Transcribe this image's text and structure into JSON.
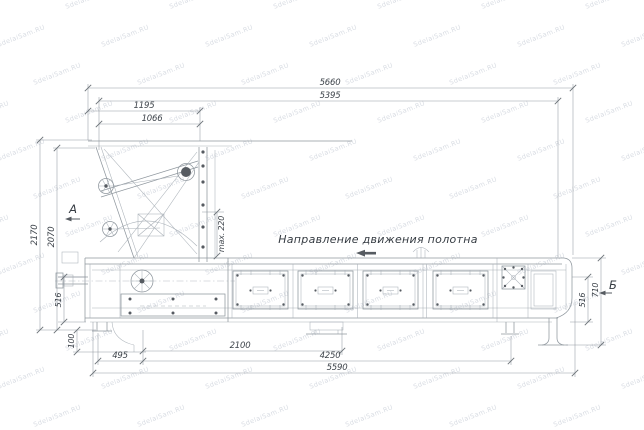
{
  "dims": {
    "d5660": "5660",
    "d5395": "5395",
    "d1195": "1195",
    "d1066": "1066",
    "d2170": "2170",
    "d2070": "2070",
    "d516_left": "516",
    "d100": "100",
    "d495": "495",
    "d2100": "2100",
    "d4250": "4250",
    "d5590": "5590",
    "d516_right": "516",
    "d710": "710",
    "dmax220": "max. 220"
  },
  "labels": {
    "view_a": "А",
    "view_b": "Б",
    "belt_direction": "Направление движения полотна"
  },
  "watermark": {
    "text": "SdelaiSam.RU",
    "color": "#ccd1da"
  },
  "colors": {
    "background": "#ffffff",
    "outline": "#8f979e",
    "thin_line": "#aab1b8",
    "dimension_line": "#939aa2",
    "text": "#3e444b",
    "dark_detail": "#565b61"
  }
}
